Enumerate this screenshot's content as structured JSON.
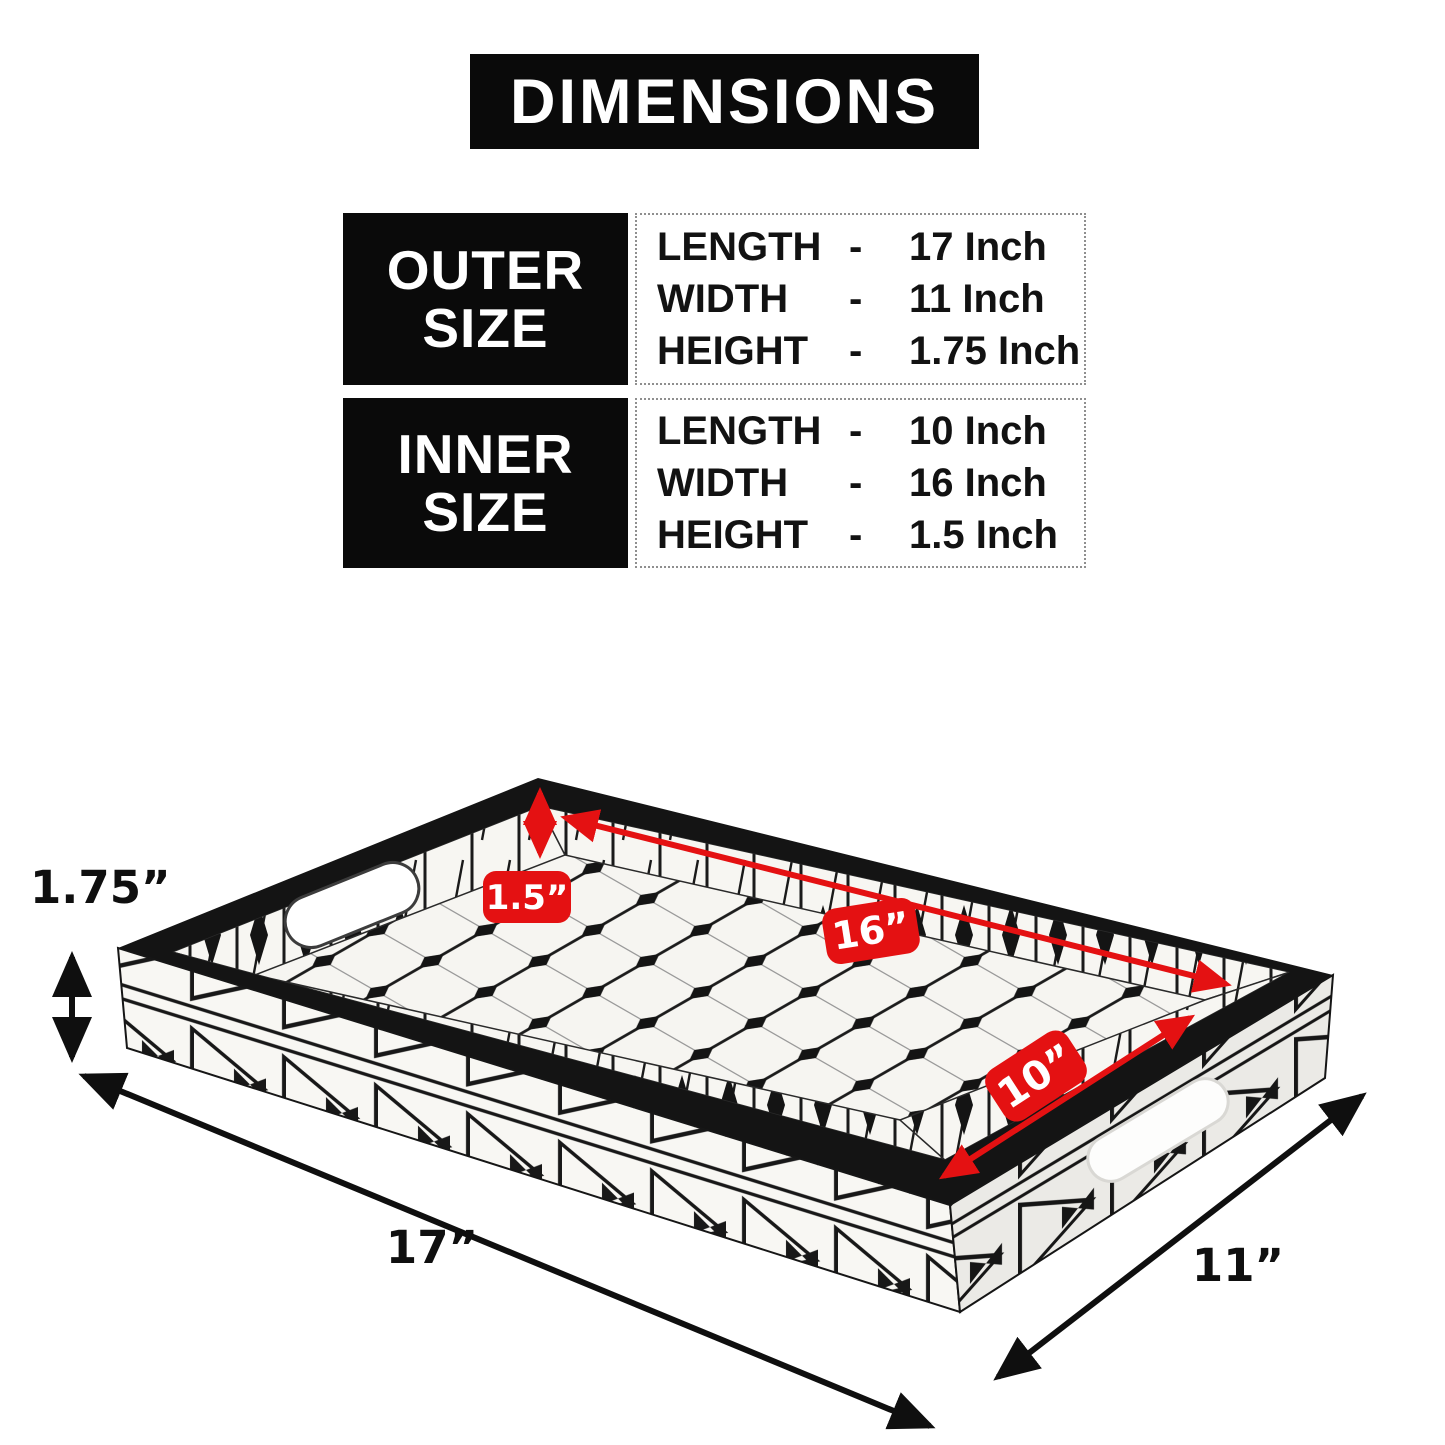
{
  "title": "DIMENSIONS",
  "colors": {
    "accent_red": "#e41112",
    "banner_black": "#0a0a0a"
  },
  "outer_size": {
    "label_line1": "OUTER",
    "label_line2": "SIZE",
    "rows": [
      {
        "label": "LENGTH",
        "dash": "-",
        "value": "17 Inch"
      },
      {
        "label": "WIDTH",
        "dash": "-",
        "value": "11 Inch"
      },
      {
        "label": "HEIGHT",
        "dash": "-",
        "value": "1.75 Inch"
      }
    ]
  },
  "inner_size": {
    "label_line1": "INNER",
    "label_line2": "SIZE",
    "rows": [
      {
        "label": "LENGTH",
        "dash": "-",
        "value": "10 Inch"
      },
      {
        "label": "WIDTH",
        "dash": "-",
        "value": "16 Inch"
      },
      {
        "label": "HEIGHT",
        "dash": "-",
        "value": "1.5 Inch"
      }
    ]
  },
  "tray_annotations": {
    "outer_height": "1.75”",
    "outer_length": "17”",
    "outer_width": "11”",
    "inner_height": "1.5”",
    "inner_width": "16”",
    "inner_length": "10”"
  }
}
